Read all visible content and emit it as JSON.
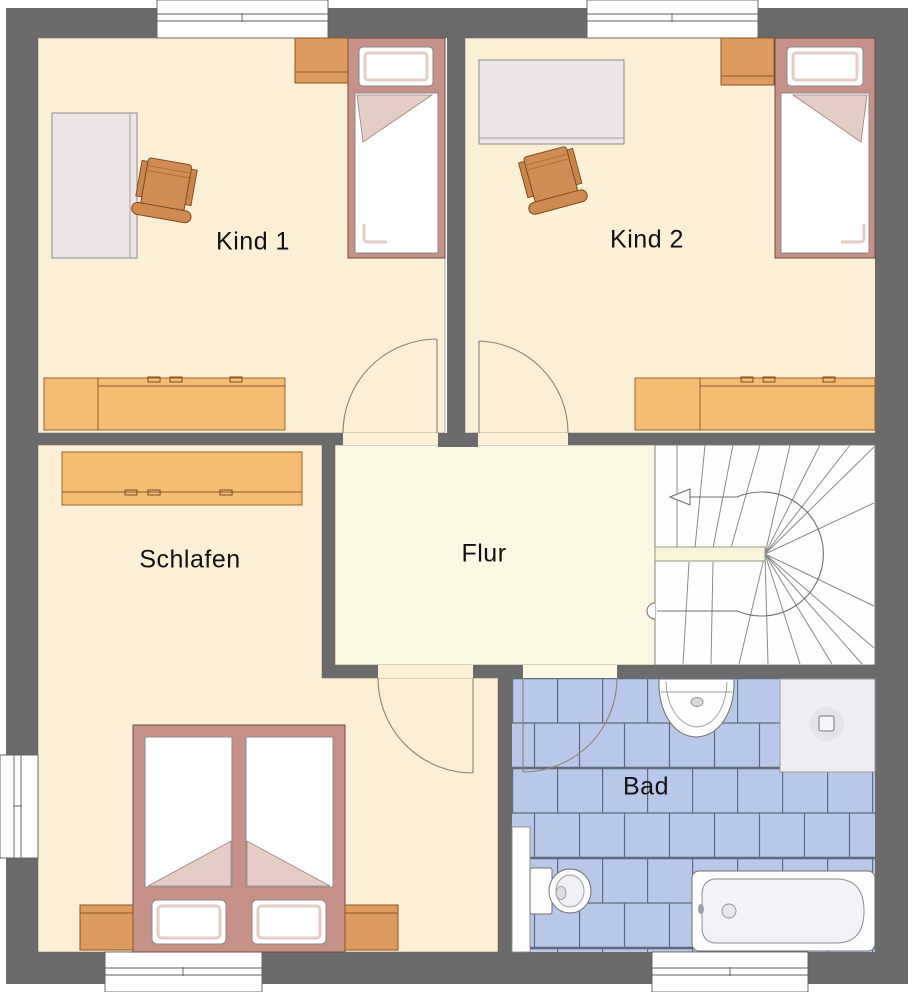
{
  "plan": {
    "type": "residential-floor-plan",
    "floor": "upper-floor",
    "language": "de"
  },
  "rooms": [
    {
      "id": "kind1",
      "label": "Kind 1",
      "features": [
        "window-top",
        "single-bed",
        "nightstand",
        "desk",
        "desk-chair",
        "sideboard",
        "door-to-hall"
      ]
    },
    {
      "id": "kind2",
      "label": "Kind 2",
      "features": [
        "window-top",
        "single-bed",
        "nightstand",
        "desk",
        "desk-chair",
        "sideboard",
        "door-to-hall"
      ]
    },
    {
      "id": "schlafen",
      "label": "Schlafen",
      "features": [
        "window-left",
        "window-bottom",
        "double-bed",
        "nightstand-left",
        "nightstand-right",
        "wardrobe",
        "door-to-hall"
      ]
    },
    {
      "id": "flur",
      "label": "Flur",
      "features": [
        "open-to-staircase"
      ]
    },
    {
      "id": "bad",
      "label": "Bad",
      "features": [
        "window-bottom",
        "tiled-floor",
        "washbasin",
        "shower",
        "toilet",
        "bathtub",
        "door-to-hall"
      ]
    }
  ],
  "staircase": {
    "type": "half-turn-winder",
    "direction_arrow": "left",
    "walkline": true
  },
  "colors": {
    "wall": "#6B6B6B",
    "room_floor": "#FBF0D6",
    "hall_floor": "#FBF9E3",
    "furniture_orange": "#F5BD74",
    "nightstand_orange": "#DD9B60",
    "chair_orange": "#D08C52",
    "bed_frame": "#C59189",
    "bed_shade_pink": "#E3CDC6",
    "desk_gray": "#EDE4E6",
    "tile_blue": "#B9C7E9",
    "tile_grout": "#5F6B7D",
    "fixture_white": "#FDFDFE",
    "outline": "#5D5D5D"
  }
}
